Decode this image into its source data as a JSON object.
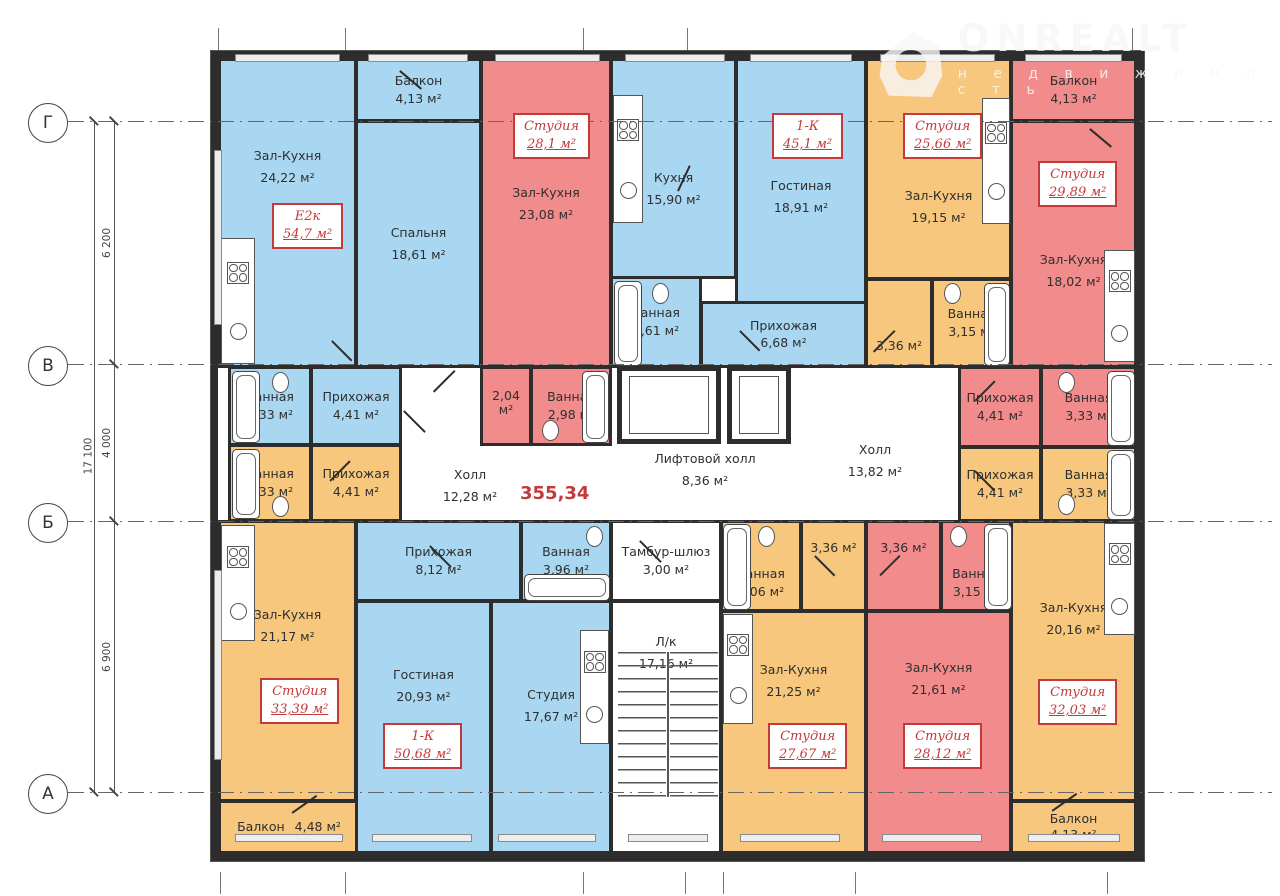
{
  "logo": {
    "title": "ONREALT",
    "subtitle": "недвижимость"
  },
  "total_area": "355,34",
  "axes": {
    "g": "Г",
    "v": "В",
    "b": "Б",
    "a": "А",
    "dim_gv": "6 200",
    "dim_vb": "4 000",
    "dim_ba": "6 900",
    "dim_total": "17 100"
  },
  "units": {
    "u1": {
      "code": "Е2к",
      "area": "54,7 м²"
    },
    "u2": {
      "code": "Студия",
      "area": "28,1 м²"
    },
    "u3": {
      "code": "1-К",
      "area": "45,1 м²"
    },
    "u4": {
      "code": "Студия",
      "area": "25,66 м²"
    },
    "u5": {
      "code": "Студия",
      "area": "29,89 м²"
    },
    "u6": {
      "code": "Студия",
      "area": "33,39 м²"
    },
    "u7": {
      "code": "1-К",
      "area": "50,68 м²"
    },
    "u8": {
      "code": "Студия",
      "area": "27,67 м²"
    },
    "u9": {
      "code": "Студия",
      "area": "28,12 м²"
    },
    "u10": {
      "code": "Студия",
      "area": "32,03 м²"
    }
  },
  "rooms": {
    "r1": {
      "name": "Зал-Кухня",
      "area": "24,22 м²"
    },
    "r2": {
      "name": "Балкон",
      "area": "4,13 м²"
    },
    "r3": {
      "name": "Спальня",
      "area": "18,61 м²"
    },
    "r4": {
      "name": "Зал-Кухня",
      "area": "23,08 м²"
    },
    "r5": {
      "name": "Кухня",
      "area": "15,90 м²"
    },
    "r6": {
      "name": "Гостиная",
      "area": "18,91 м²"
    },
    "r7": {
      "name": "Ванная",
      "area": "3,61 м²"
    },
    "r8": {
      "name": "Прихожая",
      "area": "6,68 м²"
    },
    "r9": {
      "name": "Зал-Кухня",
      "area": "19,15 м²"
    },
    "r10": {
      "name": "",
      "area": "3,36 м²"
    },
    "r11": {
      "name": "Ванная",
      "area": "3,15 м²"
    },
    "r12": {
      "name": "Балкон",
      "area": "4,13 м²"
    },
    "r13": {
      "name": "Зал-Кухня",
      "area": "18,02 м²"
    },
    "r14": {
      "name": "Ванная",
      "area": "3,33 м²"
    },
    "r15": {
      "name": "Прихожая",
      "area": "4,41 м²"
    },
    "r16": {
      "name": "",
      "area": "2,04 м²"
    },
    "r17": {
      "name": "Ванная",
      "area": "2,98 м²"
    },
    "r18": {
      "name": "Прихожая",
      "area": "4,41 м²"
    },
    "r19": {
      "name": "Ванная",
      "area": "3,33 м²"
    },
    "r20": {
      "name": "Ванная",
      "area": "3,33 м²"
    },
    "r21": {
      "name": "Прихожая",
      "area": "4,41 м²"
    },
    "r22": {
      "name": "Прихожая",
      "area": "4,41 м²"
    },
    "r23": {
      "name": "Ванная",
      "area": "3,33 м²"
    },
    "r24": {
      "name": "Холл",
      "area": "12,28 м²"
    },
    "r25": {
      "name": "Лифтовой холл",
      "area": "8,36 м²"
    },
    "r26": {
      "name": "Холл",
      "area": "13,82 м²"
    },
    "r27": {
      "name": "Зал-Кухня",
      "area": "21,17 м²"
    },
    "r28": {
      "name": "Балкон",
      "area": "4,48 м²"
    },
    "r29": {
      "name": "Прихожая",
      "area": "8,12 м²"
    },
    "r30": {
      "name": "Ванная",
      "area": "3,96 м²"
    },
    "r31": {
      "name": "Гостиная",
      "area": "20,93 м²"
    },
    "r32": {
      "name": "Студия",
      "area": "17,67 м²"
    },
    "r33": {
      "name": "Тамбур-шлюз",
      "area": "3,00 м²"
    },
    "r34": {
      "name": "Л/к",
      "area": "17,16 м²"
    },
    "r35": {
      "name": "Ванная",
      "area": "3,06 м²"
    },
    "r36": {
      "name": "",
      "area": "3,36 м²"
    },
    "r37": {
      "name": "",
      "area": "3,36 м²"
    },
    "r38": {
      "name": "Ванная",
      "area": "3,15 м²"
    },
    "r39": {
      "name": "Зал-Кухня",
      "area": "21,25 м²"
    },
    "r40": {
      "name": "Зал-Кухня",
      "area": "21,61 м²"
    },
    "r41": {
      "name": "Зал-Кухня",
      "area": "20,16 м²"
    },
    "r42": {
      "name": "Балкон",
      "area": "4,13 м²"
    }
  }
}
